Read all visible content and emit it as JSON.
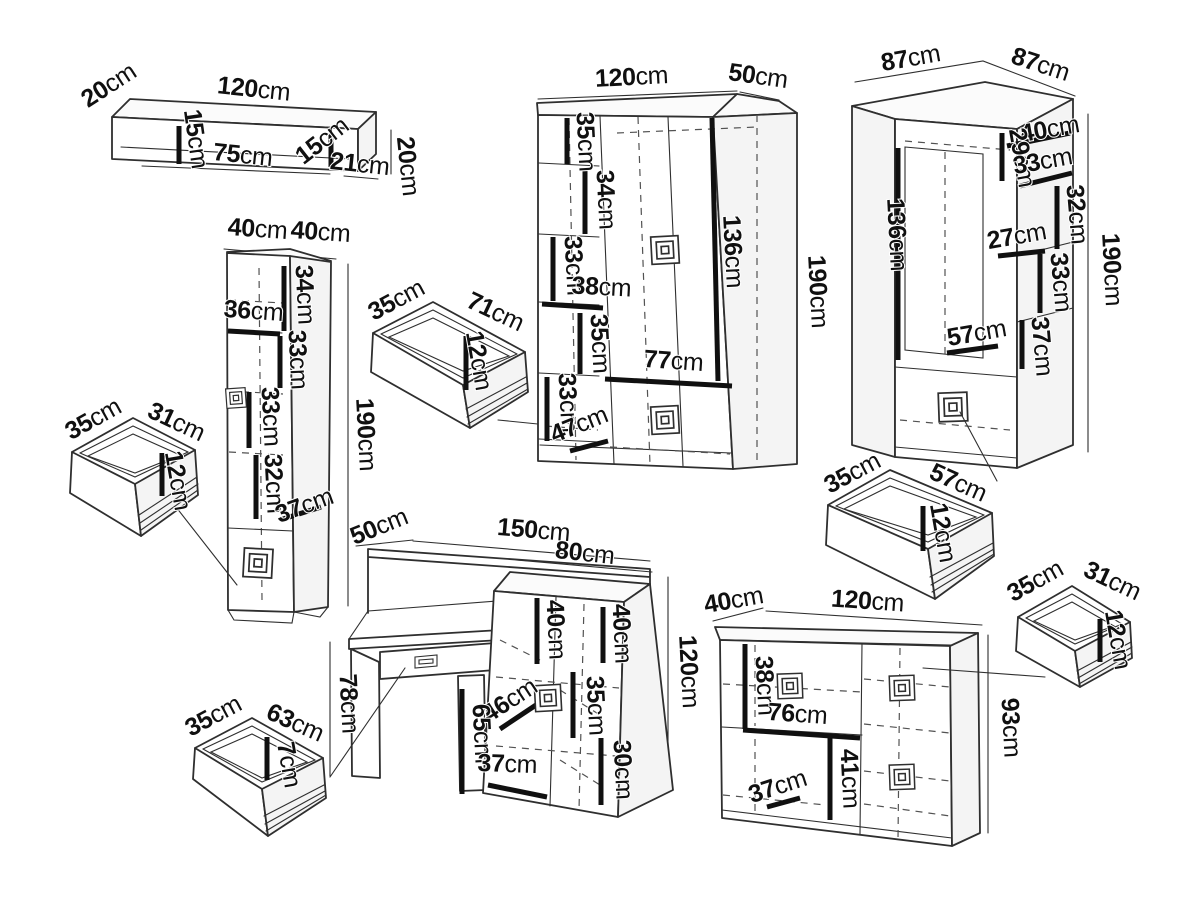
{
  "colors": {
    "background": "#ffffff",
    "line": "#2f2f2f",
    "dimension": "#101010"
  },
  "pieces": {
    "wall_shelf": {
      "dims": [
        "20cm",
        "120cm",
        "15cm",
        "75cm",
        "15cm",
        "21cm",
        "20cm"
      ]
    },
    "tall_cabinet": {
      "dims": [
        "40cm",
        "40cm",
        "34cm",
        "36cm",
        "33cm",
        "33cm",
        "32cm",
        "37cm",
        "190cm"
      ]
    },
    "drawer_small_left": {
      "dims": [
        "35cm",
        "31cm",
        "12cm"
      ]
    },
    "drawer_mid": {
      "dims": [
        "35cm",
        "71cm",
        "12cm"
      ]
    },
    "wardrobe": {
      "dims": [
        "120cm",
        "50cm",
        "35cm",
        "34cm",
        "33cm",
        "38cm",
        "35cm",
        "33cm",
        "47cm",
        "77cm",
        "136cm",
        "190cm"
      ]
    },
    "corner_wardrobe": {
      "dims": [
        "87cm",
        "87cm",
        "40cm",
        "29cm",
        "33cm",
        "32cm",
        "27cm",
        "33cm",
        "37cm",
        "57cm",
        "136cm",
        "190cm"
      ]
    },
    "drawer_right": {
      "dims": [
        "35cm",
        "57cm",
        "12cm"
      ]
    },
    "desk": {
      "dims": [
        "50cm",
        "150cm",
        "80cm",
        "40cm",
        "40cm",
        "120cm",
        "35cm",
        "46cm",
        "65cm",
        "30cm",
        "37cm",
        "78cm"
      ]
    },
    "drawer_bottom_left": {
      "dims": [
        "35cm",
        "63cm",
        "7cm"
      ]
    },
    "dresser": {
      "dims": [
        "40cm",
        "120cm",
        "38cm",
        "76cm",
        "41cm",
        "37cm",
        "93cm"
      ]
    },
    "drawer_bottom_right": {
      "dims": [
        "35cm",
        "31cm",
        "12cm"
      ]
    }
  }
}
